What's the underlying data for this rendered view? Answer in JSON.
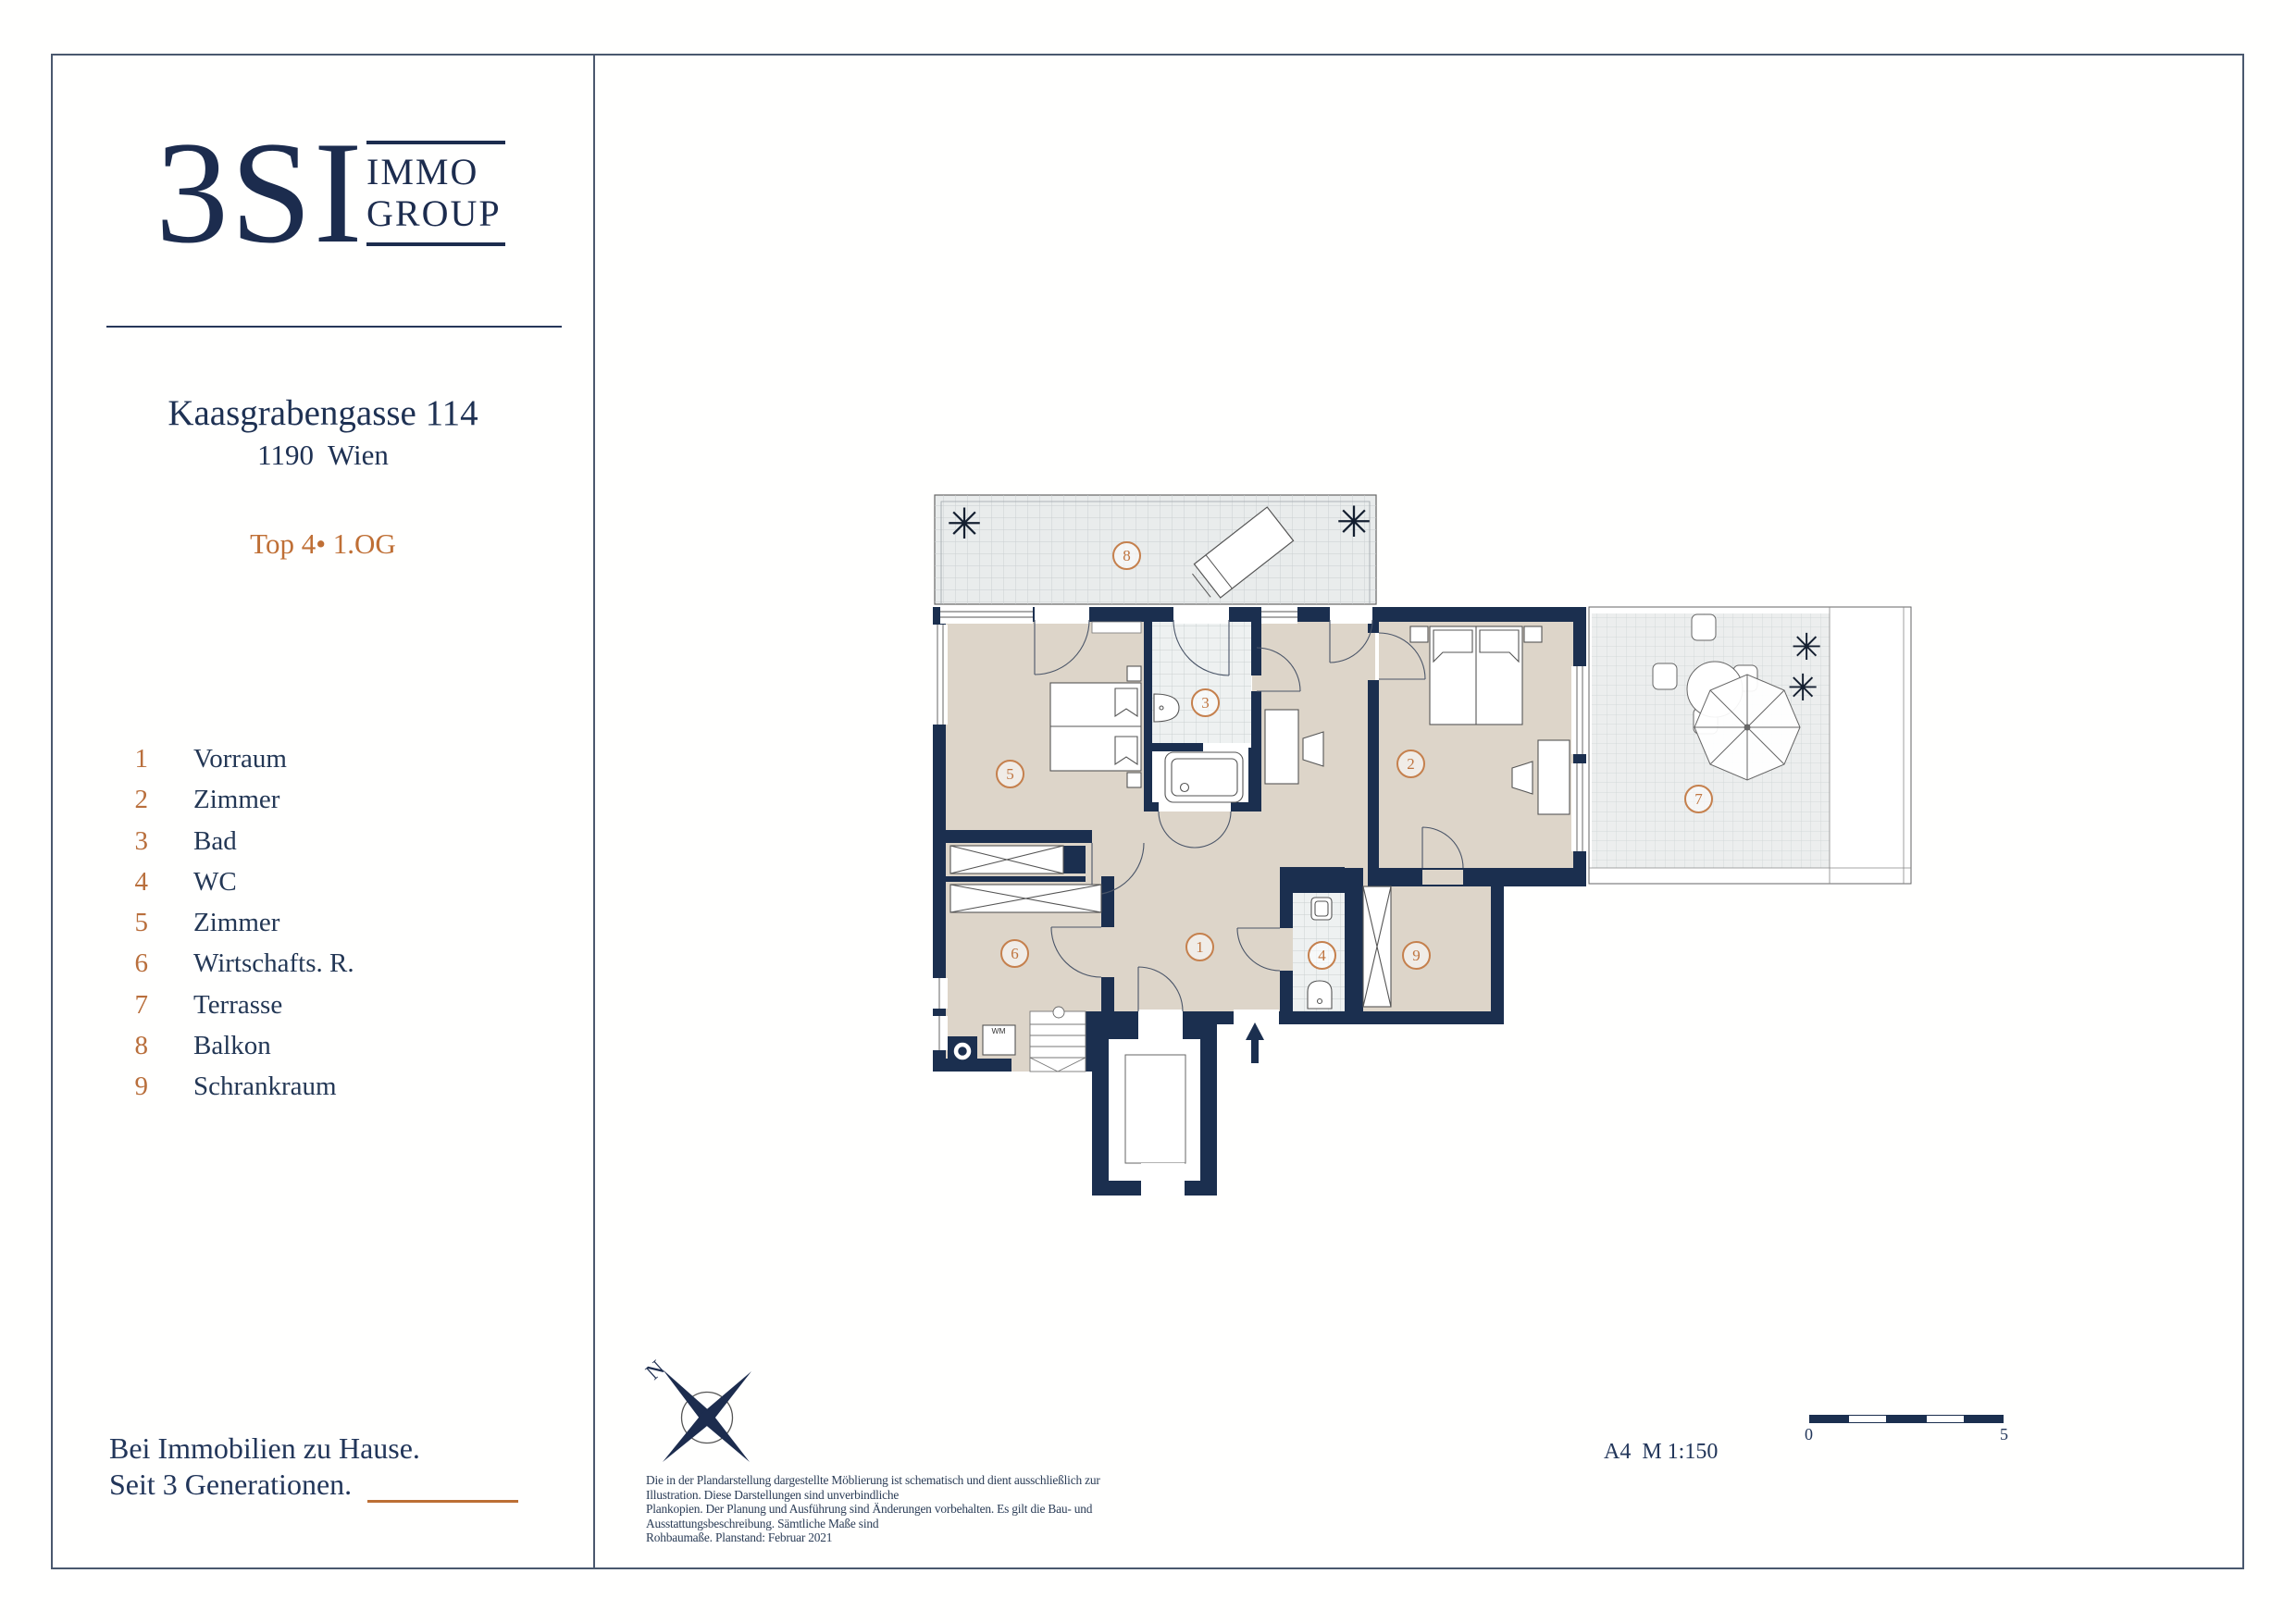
{
  "brand": {
    "logo": "3SI",
    "immo": "IMMO",
    "group": "GROUP"
  },
  "project": {
    "address": "Kaasgrabengasse 114",
    "city": "1190  Wien",
    "unit": "Top 4• 1.OG"
  },
  "legend": {
    "items": [
      {
        "num": "1",
        "label": "Vorraum"
      },
      {
        "num": "2",
        "label": "Zimmer"
      },
      {
        "num": "3",
        "label": "Bad"
      },
      {
        "num": "4",
        "label": "WC"
      },
      {
        "num": "5",
        "label": "Zimmer"
      },
      {
        "num": "6",
        "label": "Wirtschafts. R."
      },
      {
        "num": "7",
        "label": "Terrasse"
      },
      {
        "num": "8",
        "label": "Balkon"
      },
      {
        "num": "9",
        "label": "Schrankraum"
      }
    ]
  },
  "plan": {
    "rooms": [
      {
        "num": "1"
      },
      {
        "num": "2"
      },
      {
        "num": "3"
      },
      {
        "num": "4"
      },
      {
        "num": "5"
      },
      {
        "num": "6"
      },
      {
        "num": "7"
      },
      {
        "num": "8"
      },
      {
        "num": "9"
      }
    ],
    "wm_label": "WM",
    "icons": {
      "plant": "✳"
    },
    "colors": {
      "wall": "#1b2f4f",
      "room_fill": "#ddd5c9",
      "accent_orange": "#bf6f35",
      "tile": "#eef0f0"
    }
  },
  "annotations": {
    "north": "N",
    "sheet_scale": "A4  M 1:150",
    "scale_start": "0",
    "scale_end": "5"
  },
  "footer": {
    "tagline1": "Bei Immobilien zu Hause.",
    "tagline2": "Seit 3 Generationen."
  },
  "disclaimer": {
    "line1": "Die in der Plandarstellung dargestellte Möblierung ist schematisch und dient ausschließlich zur Illustration. Diese Darstellungen sind unverbindliche",
    "line2": "Plankopien. Der Planung und Ausführung sind Änderungen vorbehalten. Es gilt die Bau- und Ausstattungsbeschreibung. Sämtliche Maße sind",
    "line3": "Rohbaumaße. Planstand: Februar 2021"
  }
}
